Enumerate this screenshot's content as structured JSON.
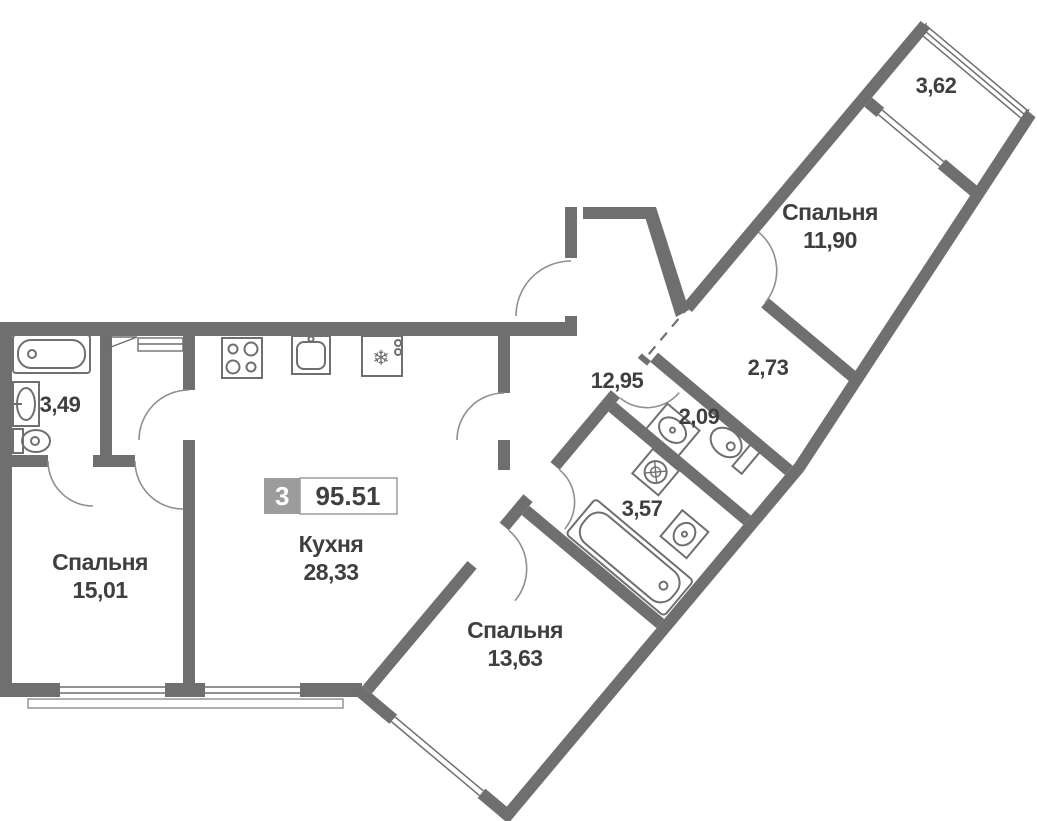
{
  "plan": {
    "badge": {
      "room_count": "3",
      "total_area": "95.51"
    },
    "labels": {
      "bathroom_left_area": "3,49",
      "bedroom_left_name": "Спальня",
      "bedroom_left_area": "15,01",
      "kitchen_name": "Кухня",
      "kitchen_area": "28,33",
      "hall_area": "12,95",
      "bedroom_bottom_name": "Спальня",
      "bedroom_bottom_area": "13,63",
      "bathroom_right_area": "3,57",
      "wc_area": "2,09",
      "corridor_area": "2,73",
      "bedroom_right_name": "Спальня",
      "bedroom_right_area": "11,90",
      "loggia_area": "3,62"
    },
    "icons": {
      "fridge_glyph": "❄"
    },
    "fixtures": {
      "bathroom_left": [
        "bathtub",
        "sink",
        "toilet"
      ],
      "kitchen": [
        "stove",
        "kitchen-sink",
        "fridge"
      ],
      "bathroom_right": [
        "bathtub",
        "washing-machine",
        "sink"
      ],
      "wc": [
        "sink",
        "toilet"
      ]
    },
    "colors": {
      "wall": "#6f6f6f",
      "text": "#3f3f3f",
      "badge_bg": "#9c9c9c",
      "badge_text": "#ffffff",
      "background": "#ffffff"
    }
  }
}
